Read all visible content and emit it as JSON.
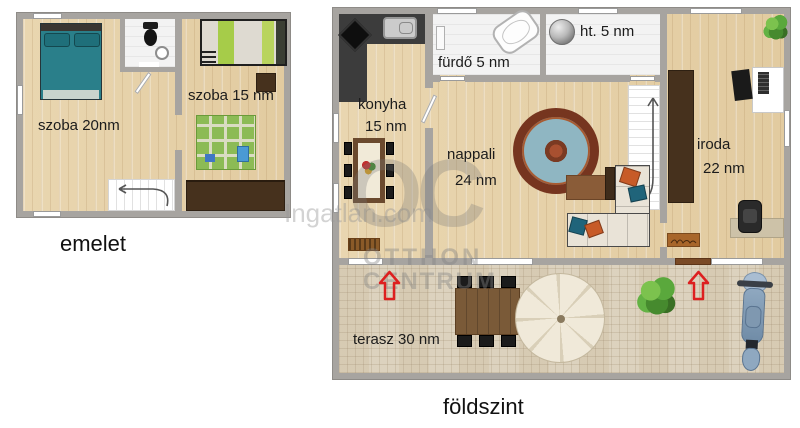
{
  "watermark": {
    "site_text": "Ingatlan.com",
    "logo_text": "OC",
    "logo_line1": "OTTHON",
    "logo_line2": "CENTRUM"
  },
  "upper_floor": {
    "caption": "emelet",
    "room_large": "szoba 20nm",
    "room_small": "szoba 15 nm"
  },
  "ground_floor": {
    "caption": "földszint",
    "kitchen_name": "konyha",
    "kitchen_area": "15 nm",
    "bathroom_label": "fürdő 5 nm",
    "utility_label": "ht. 5 nm",
    "living_name": "nappali",
    "living_area": "24 nm",
    "office_name": "iroda",
    "office_area": "22 nm",
    "terrace_label": "terasz 30 nm"
  },
  "colors": {
    "wall_gray": "#a7a4a0",
    "wood_floor": "#e6d1aa",
    "terrace_floor": "#e8dfcc",
    "entrance_arrow_red": "#dd2020",
    "teal_bed": "#2a7f8a",
    "lime_bedding": "#a6cc49",
    "dark_wood_furniture": "#46311d",
    "watermark_gray": "#9a9a9a"
  }
}
